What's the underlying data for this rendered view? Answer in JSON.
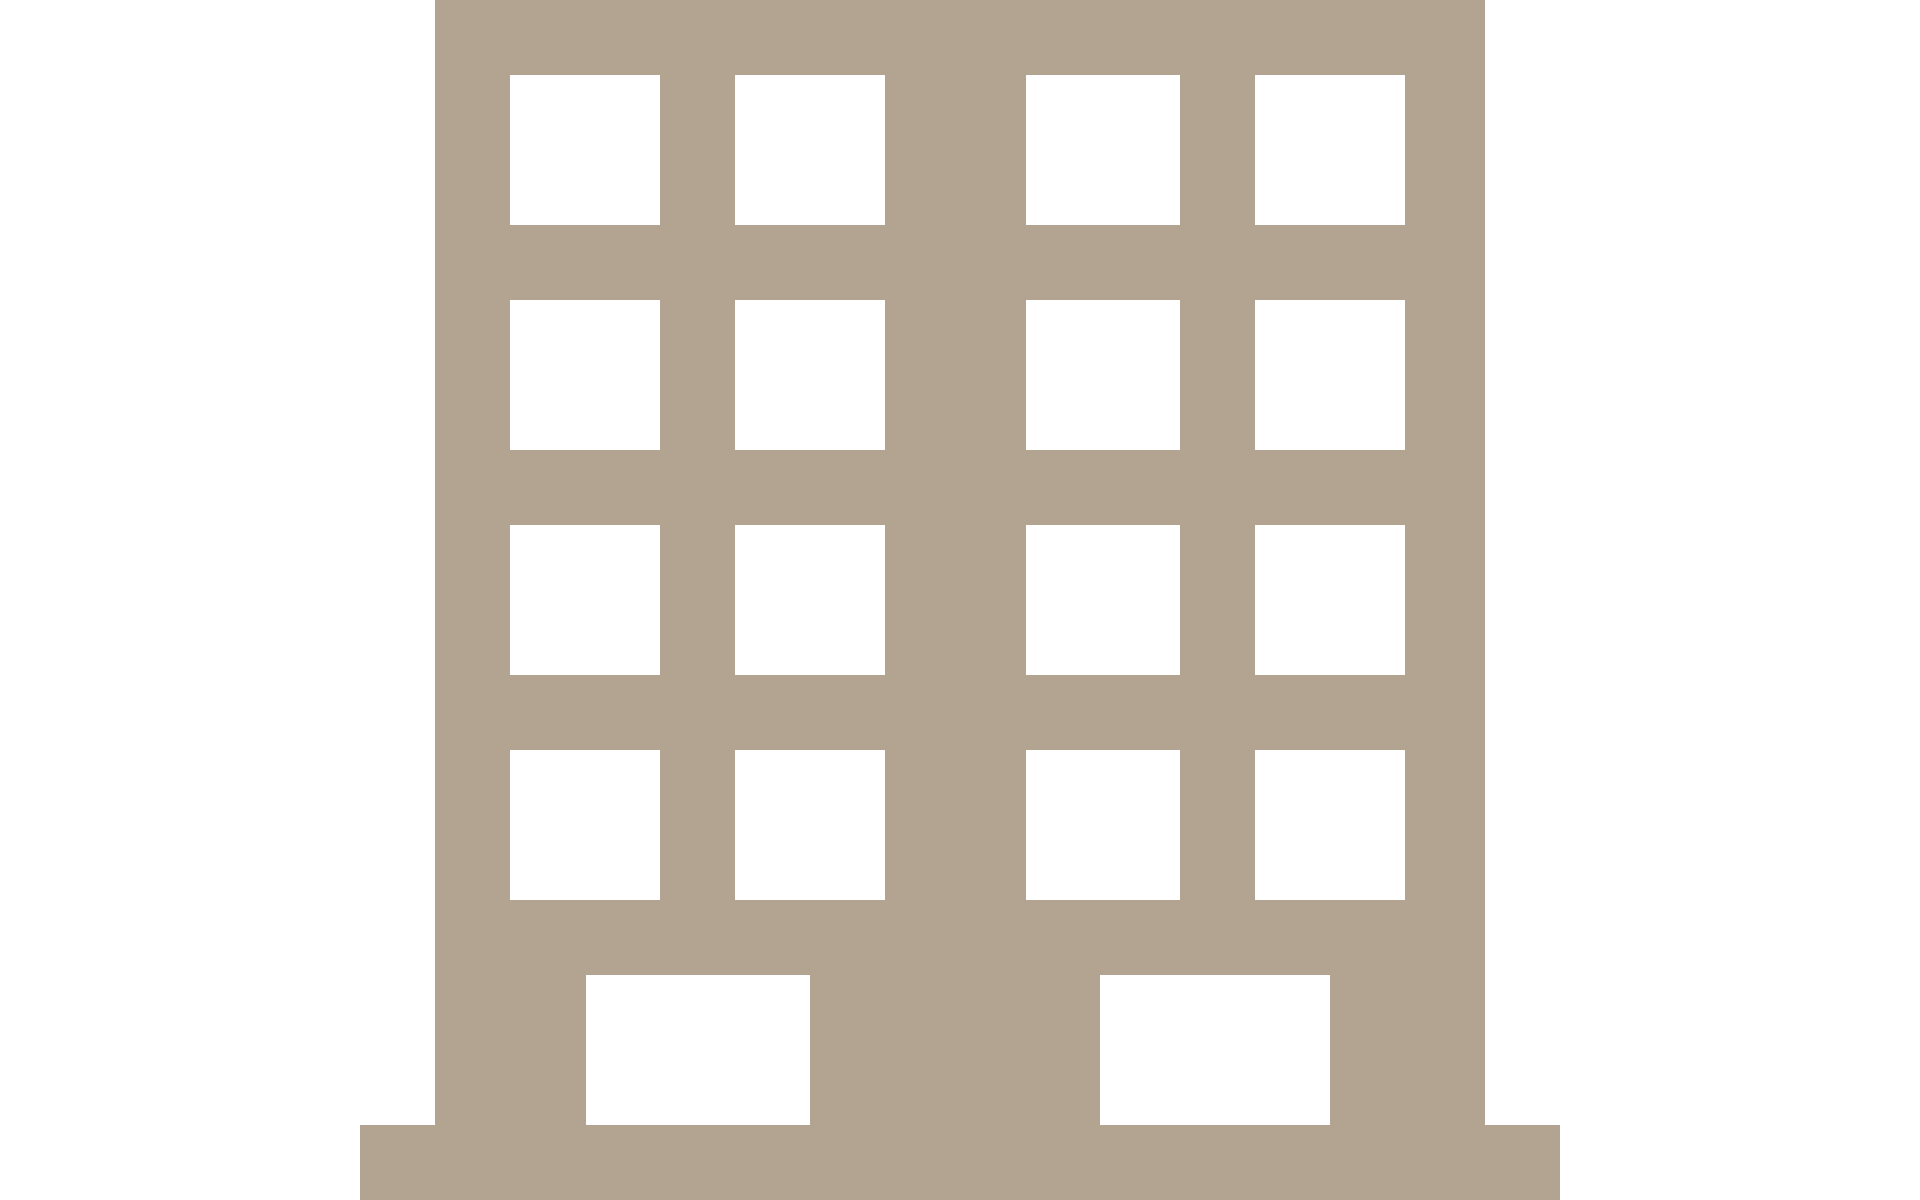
{
  "canvas": {
    "width": 1920,
    "height": 1200,
    "background_color": "#ffffff"
  },
  "icon": {
    "label": "building-pictogram",
    "color": "#b3a492",
    "body": {
      "x": 435,
      "y": 0,
      "w": 1050,
      "h": 1125
    },
    "base": {
      "x": 360,
      "y": 1125,
      "w": 1200,
      "h": 75
    },
    "windows": [
      {
        "x": 510,
        "y": 75,
        "w": 150,
        "h": 150
      },
      {
        "x": 735,
        "y": 75,
        "w": 150,
        "h": 150
      },
      {
        "x": 1026,
        "y": 75,
        "w": 154,
        "h": 150
      },
      {
        "x": 1255,
        "y": 75,
        "w": 150,
        "h": 150
      },
      {
        "x": 510,
        "y": 300,
        "w": 150,
        "h": 150
      },
      {
        "x": 735,
        "y": 300,
        "w": 150,
        "h": 150
      },
      {
        "x": 1026,
        "y": 300,
        "w": 154,
        "h": 150
      },
      {
        "x": 1255,
        "y": 300,
        "w": 150,
        "h": 150
      },
      {
        "x": 510,
        "y": 525,
        "w": 150,
        "h": 150
      },
      {
        "x": 735,
        "y": 525,
        "w": 150,
        "h": 150
      },
      {
        "x": 1026,
        "y": 525,
        "w": 154,
        "h": 150
      },
      {
        "x": 1255,
        "y": 525,
        "w": 150,
        "h": 150
      },
      {
        "x": 510,
        "y": 750,
        "w": 150,
        "h": 150
      },
      {
        "x": 735,
        "y": 750,
        "w": 150,
        "h": 150
      },
      {
        "x": 1026,
        "y": 750,
        "w": 154,
        "h": 150
      },
      {
        "x": 1255,
        "y": 750,
        "w": 150,
        "h": 150
      }
    ],
    "doors": [
      {
        "x": 586,
        "y": 975,
        "w": 224,
        "h": 150
      },
      {
        "x": 1100,
        "y": 975,
        "w": 230,
        "h": 150
      }
    ]
  }
}
